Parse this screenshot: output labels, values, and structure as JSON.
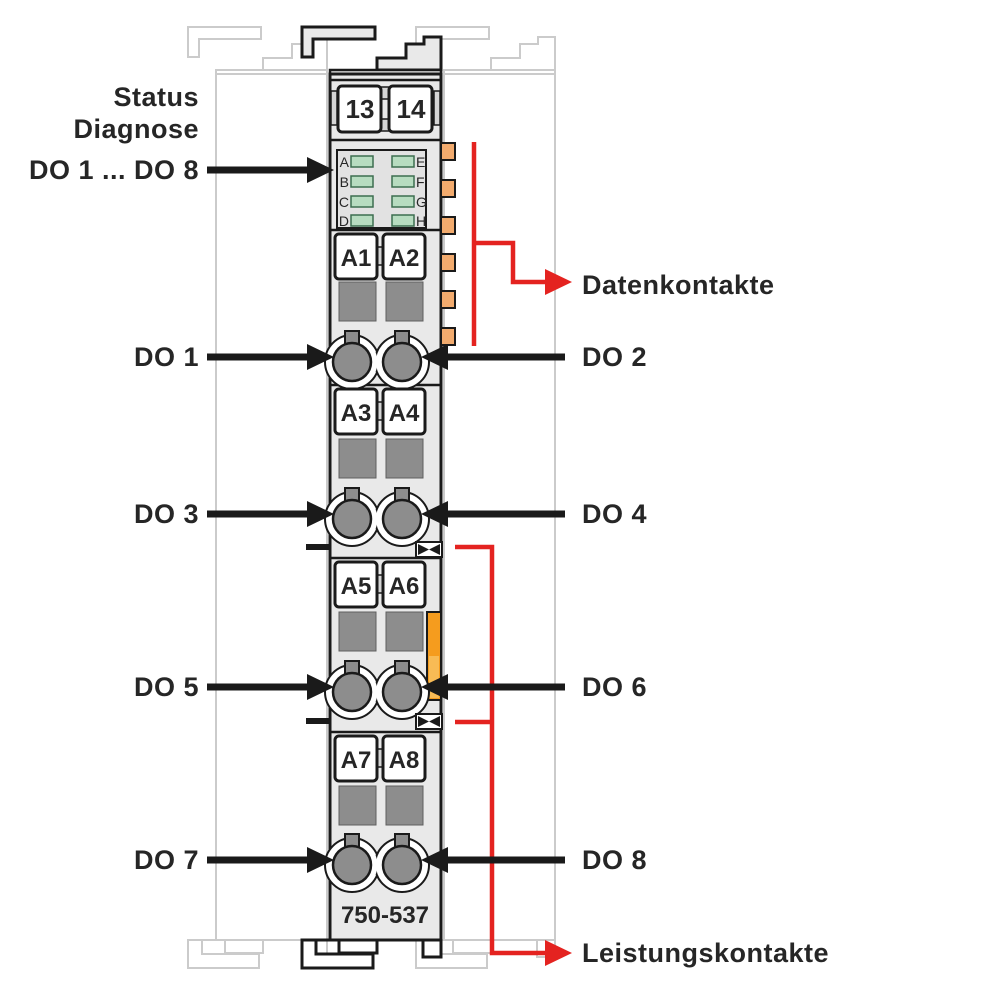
{
  "labels": {
    "status": "Status",
    "diagnose": "Diagnose",
    "do_range": "DO 1 ... DO 8",
    "do1": "DO 1",
    "do2": "DO 2",
    "do3": "DO 3",
    "do4": "DO 4",
    "do5": "DO 5",
    "do6": "DO 6",
    "do7": "DO 7",
    "do8": "DO 8",
    "datenkontakte": "Datenkontakte",
    "leistungskontakte": "Leistungskontakte"
  },
  "module": {
    "part_number": "750-537",
    "top_terminals": [
      "13",
      "14"
    ],
    "terminals": [
      "A1",
      "A2",
      "A3",
      "A4",
      "A5",
      "A6",
      "A7",
      "A8"
    ],
    "led_left": [
      "A",
      "B",
      "C",
      "D"
    ],
    "led_right": [
      "E",
      "F",
      "G",
      "H"
    ]
  },
  "colors": {
    "red": "#e42320",
    "body_gray": "#e9e9e9",
    "outline": "#1a1a1a",
    "slot_gray": "#8d8d8d",
    "led_green": "#b7dcc0",
    "data_contact_orange": "#f2ab6e",
    "side_contact_orange": "#f59c1e",
    "neighbor_gray": "#cbcbcb"
  }
}
